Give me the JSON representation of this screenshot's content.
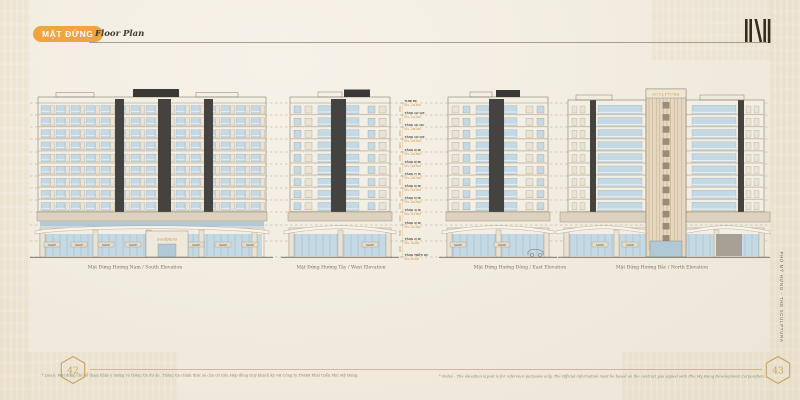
{
  "header": {
    "badge": "MẶT ĐỨNG",
    "subtitle": "Floor Plan"
  },
  "brand": {
    "side_text": "PHÚ MỸ HƯNG - THE SCULPTURA",
    "tower_sign": "SCULPTURA",
    "entrance_sign": "Sculptura"
  },
  "elevations": [
    {
      "caption": "Mặt Đứng Hướng Nam / South Elevation"
    },
    {
      "caption": "Mặt Đứng Hướng Tây / West Elevation"
    },
    {
      "caption": "Mặt Đứng Hướng Đông / East Elevation"
    },
    {
      "caption": "Mặt Đứng Hướng Bắc / North Elevation"
    }
  ],
  "shop_label": "SHOP",
  "floor_levels": [
    {
      "name": "TUM/ RF",
      "ffl": "FFL +44.600"
    },
    {
      "name": "TẦNG 12/ 12F",
      "ffl": "FFL +41.400"
    },
    {
      "name": "TẦNG 11/ 11F",
      "ffl": "FFL +38.200"
    },
    {
      "name": "TẦNG 10/ 10F",
      "ffl": "FFL +35.000"
    },
    {
      "name": "TẦNG 9/ 9F",
      "ffl": "FFL +31.800"
    },
    {
      "name": "TẦNG 8/ 8F",
      "ffl": "FFL +28.600"
    },
    {
      "name": "TẦNG 7/ 7F",
      "ffl": "FFL +25.400"
    },
    {
      "name": "TẦNG 6/ 6F",
      "ffl": "FFL +22.200"
    },
    {
      "name": "TẦNG 5/ 5F",
      "ffl": "FFL +19.000"
    },
    {
      "name": "TẦNG 4/ 4F",
      "ffl": "FFL +15.800"
    },
    {
      "name": "TẦNG 3/ 3F",
      "ffl": "FFL +11.000"
    },
    {
      "name": "TẦNG 2/ 2F",
      "ffl": "FFL +6.000"
    },
    {
      "name": "TẦNG TRỆT/ GF",
      "ffl": "FFL ±0.000"
    }
  ],
  "floor_dims": [
    "3200",
    "3200",
    "3200",
    "3200",
    "3200",
    "3200",
    "3200",
    "3200",
    "3200",
    "3200",
    "5000",
    "6000"
  ],
  "footer": {
    "page_left": "42",
    "page_right": "43",
    "note_vi": "* Lưu ý: Mặt đứng chỉ để tham khảo ý tưởng và thông tin dự án. Thông tin chính thức sẽ căn cứ trên Hợp đồng Quý khách ký với Công ty TNHH Phát triển Phú Mỹ Hưng.",
    "note_en": "* Notes : The elevation layout is for reference purposes only. The Official information must be based on the contract you signed with Phu My Hung Development Corporation."
  },
  "colors": {
    "accent_orange": "#efa443",
    "ffl_orange": "#d78f2f",
    "gold": "#c6a55e",
    "facade": "#f4efe5",
    "line": "#867d6c",
    "glass": "#c5d9e4",
    "glass_dark": "#b1c9d6",
    "slab": "#cfc3ad",
    "dark_core": "#45433f",
    "tan_band": "#ddd2bf",
    "canopy": "#f8f4eb",
    "sign_bg": "#e5dcc8",
    "sign_text": "#57503f",
    "caption_text": "#7b7265",
    "note_text": "#8b8376",
    "dash_line": "#b5aa92",
    "logo_dark": "#352c1f"
  }
}
